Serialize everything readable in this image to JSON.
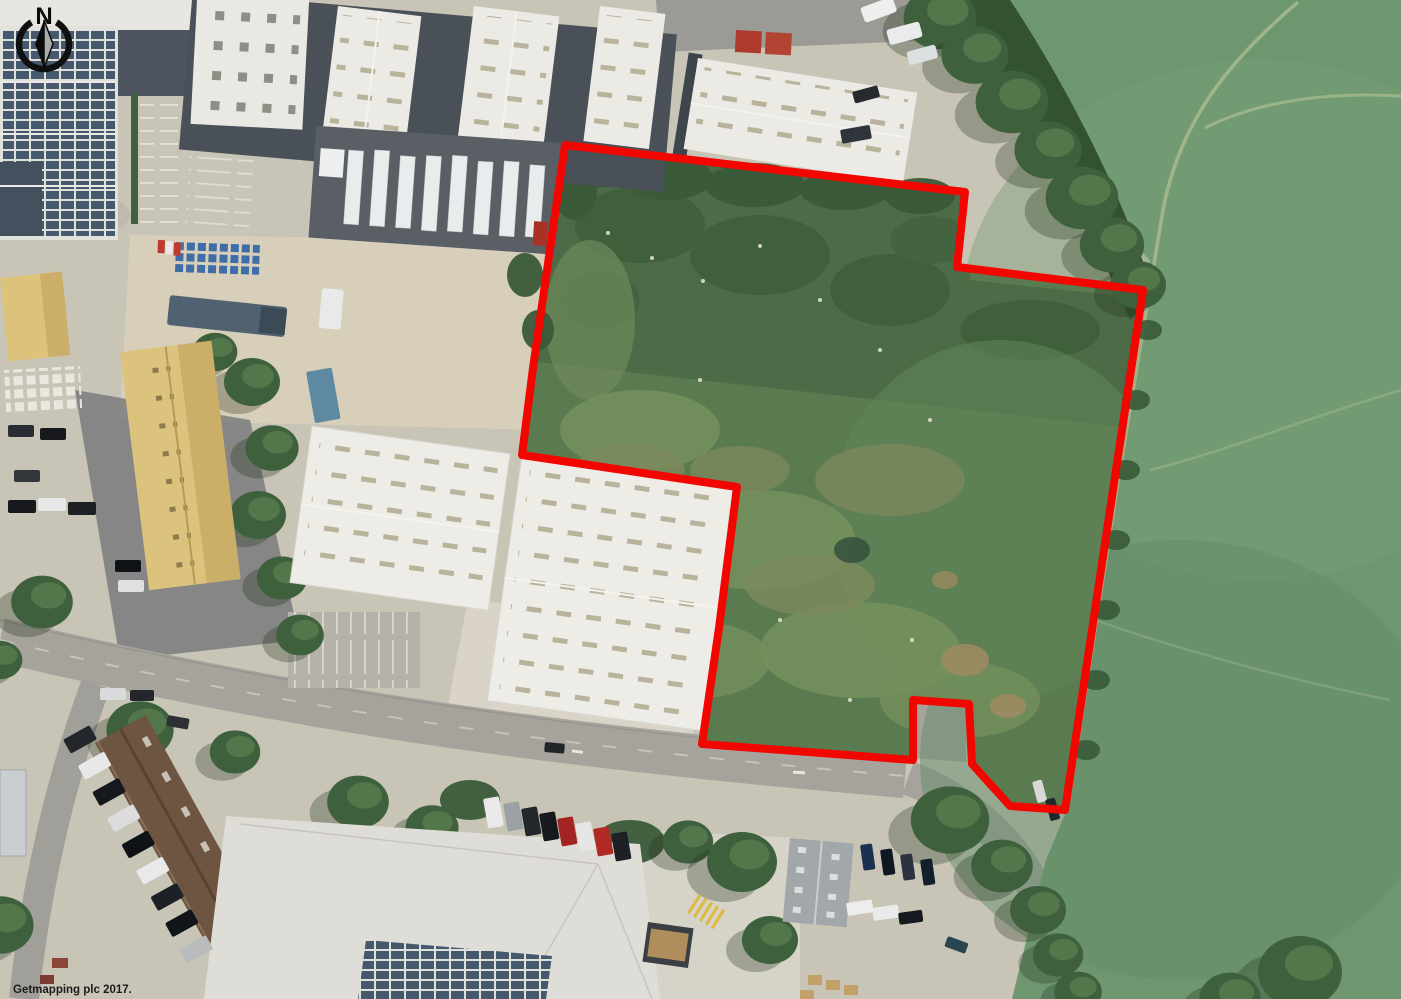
{
  "map": {
    "type": "aerial-photograph-with-site-boundary",
    "attribution": "Getmapping plc 2017.",
    "compass": {
      "label": "N",
      "color": "#101010"
    },
    "site_boundary": {
      "color": "#f20600",
      "stroke_width": 8,
      "points": [
        [
          565,
          145
        ],
        [
          965,
          192
        ],
        [
          957,
          267
        ],
        [
          1143,
          290
        ],
        [
          1065,
          810
        ],
        [
          1010,
          806
        ],
        [
          972,
          764
        ],
        [
          969,
          704
        ],
        [
          913,
          700
        ],
        [
          913,
          760
        ],
        [
          702,
          744
        ],
        [
          719,
          628
        ],
        [
          737,
          487
        ],
        [
          522,
          455
        ],
        [
          533,
          368
        ]
      ]
    }
  }
}
